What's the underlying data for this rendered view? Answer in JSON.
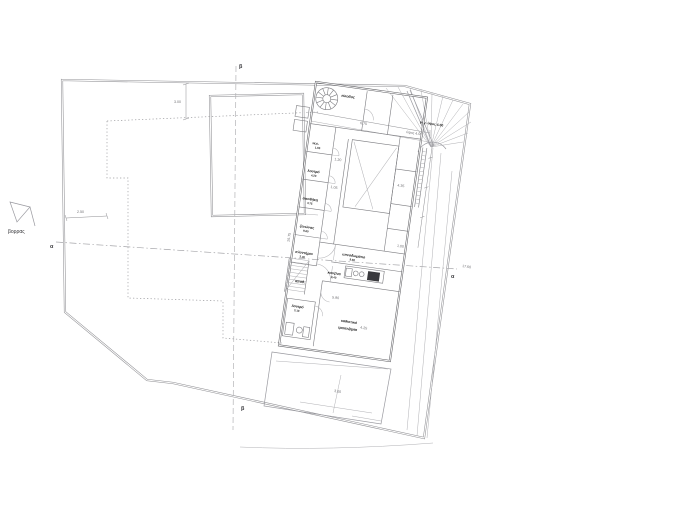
{
  "canvas": {
    "width": 700,
    "height": 529,
    "background": "#ffffff",
    "line_color": "#9a9aa0",
    "wall_color": "#5f5f63",
    "label_color": "#141414",
    "dim_color": "#6f6f73"
  },
  "compass": {
    "label": "βορρας"
  },
  "sections": {
    "alpha": "α",
    "beta": "β"
  },
  "notes": {
    "max_height": "μεγ. ύψος 4.00",
    "height": "ύψος 4.00"
  },
  "dims": {
    "plot_top": "3.00",
    "plot_left": "2.50",
    "entry_width": "6.75",
    "living": "4.25",
    "terrace": "3.00",
    "section_line": "17.60",
    "side_wall": "26.75",
    "bed_width": "4.35",
    "cell": "1.20",
    "cell2": "1.05",
    "shaft": "1.00",
    "living_width": "5.90"
  },
  "rooms": [
    {
      "name": "w.c.",
      "area": "1.80"
    },
    {
      "name": "λουτρό",
      "area": "4.20"
    },
    {
      "name": "αποθήκη",
      "area": "3.75"
    },
    {
      "name": "ξενώνας",
      "area": "9.60"
    },
    {
      "name": "πλυντήριο",
      "area": "2.40"
    },
    {
      "name": "υπνοδωμάτιο",
      "area": "9.80"
    },
    {
      "name": "κουζίνα",
      "area": "8.40"
    },
    {
      "name": "λουτρό",
      "area": "3.10"
    },
    {
      "name": "καθιστικό",
      "sub": "τραπεζαρία"
    },
    {
      "name": "είσοδος"
    },
    {
      "name": "αποθ."
    }
  ]
}
